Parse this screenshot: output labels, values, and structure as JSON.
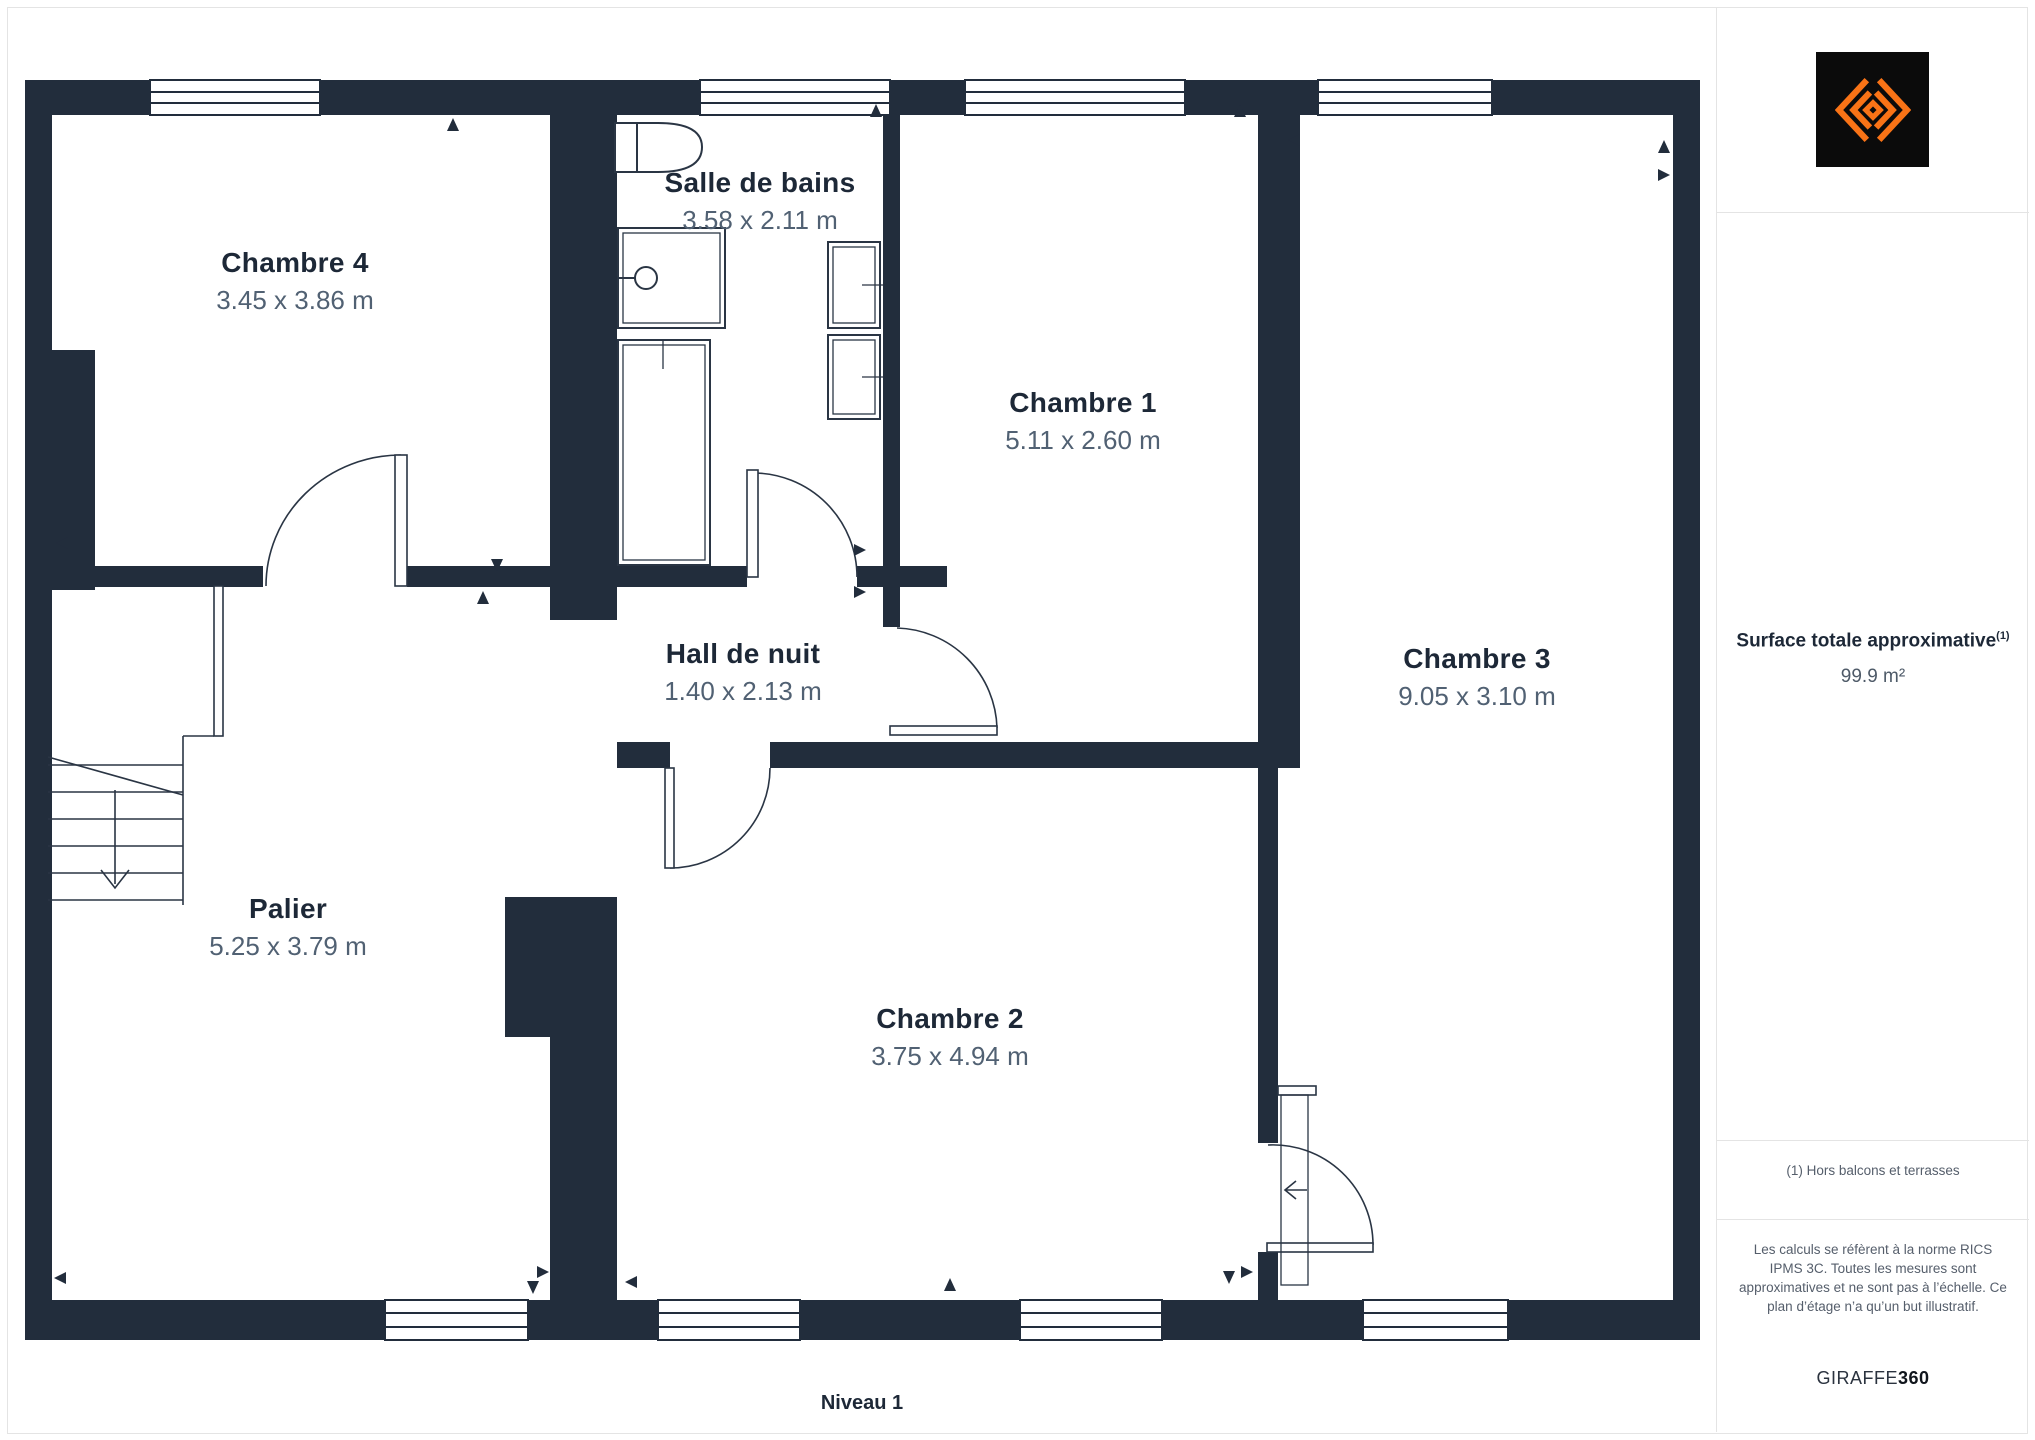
{
  "floor": {
    "label": "Niveau 1"
  },
  "rooms": [
    {
      "name": "Chambre 4",
      "dims": "3.45 x 3.86 m"
    },
    {
      "name": "Salle de bains",
      "dims": "3.58 x 2.11 m"
    },
    {
      "name": "Chambre 1",
      "dims": "5.11 x 2.60 m"
    },
    {
      "name": "Hall de nuit",
      "dims": "1.40 x 2.13 m"
    },
    {
      "name": "Chambre 3",
      "dims": "9.05 x 3.10 m"
    },
    {
      "name": "Palier",
      "dims": "5.25 x 3.79 m"
    },
    {
      "name": "Chambre 2",
      "dims": "3.75 x 4.94 m"
    }
  ],
  "sidebar": {
    "surface_title": "Surface totale approximative",
    "surface_title_superscript": "(1)",
    "surface_value": "99.9 m²",
    "footnote": "(1) Hors balcons et terrasses",
    "disclaimer": "Les calculs se réfèrent à la norme RICS IPMS 3C. Toutes les mesures sont approximatives et ne sont pas à l’échelle. Ce plan d’étage n’a qu’un but illustratif.",
    "brand_name": "GIRAFFE",
    "brand_number": "360"
  },
  "icons": {
    "logo": "giraffe360-diamond-logo"
  },
  "colors": {
    "wall": "#222d3c",
    "line": "#2a3544",
    "room_title_text": "#1d2837",
    "room_dims_text": "#516173",
    "muted_text": "#555e6b",
    "divider": "#e4e4e4",
    "logo_background": "#0b0b0b",
    "logo_orange": "#f97316"
  }
}
